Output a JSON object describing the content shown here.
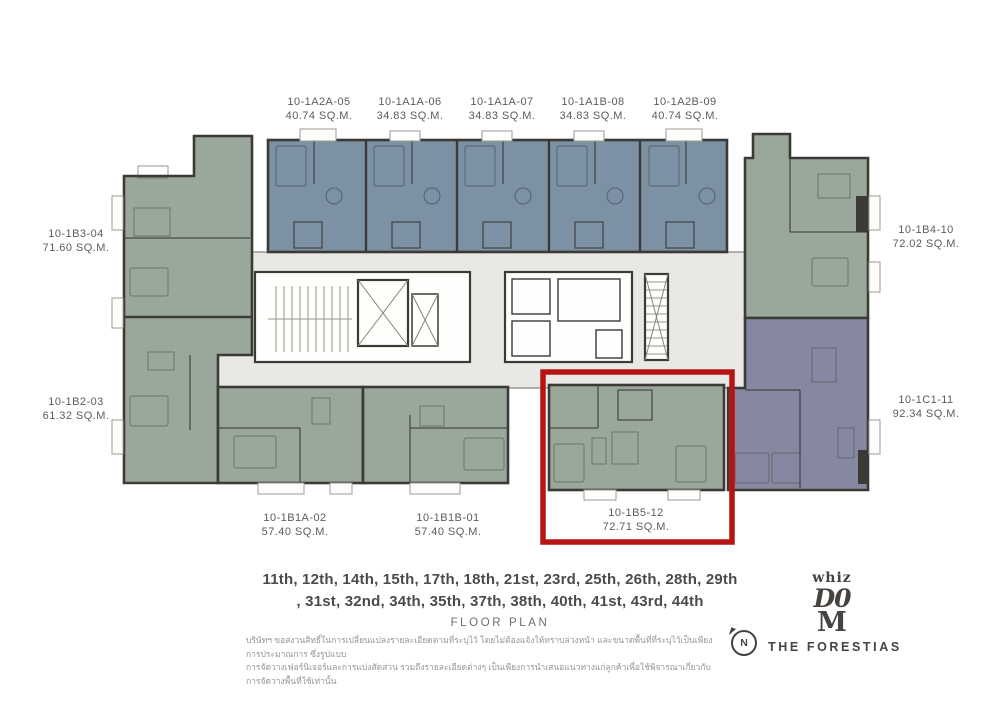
{
  "units": {
    "top": [
      {
        "id": "10-1A2A-05",
        "area": "40.74 SQ.M."
      },
      {
        "id": "10-1A1A-06",
        "area": "34.83 SQ.M."
      },
      {
        "id": "10-1A1A-07",
        "area": "34.83 SQ.M."
      },
      {
        "id": "10-1A1B-08",
        "area": "34.83 SQ.M."
      },
      {
        "id": "10-1A2B-09",
        "area": "40.74 SQ.M."
      }
    ],
    "left": [
      {
        "id": "10-1B3-04",
        "area": "71.60 SQ.M."
      },
      {
        "id": "10-1B2-03",
        "area": "61.32 SQ.M."
      }
    ],
    "right": [
      {
        "id": "10-1B4-10",
        "area": "72.02 SQ.M."
      },
      {
        "id": "10-1C1-11",
        "area": "92.34 SQ.M."
      }
    ],
    "bottom": [
      {
        "id": "10-1B1A-02",
        "area": "57.40 SQ.M."
      },
      {
        "id": "10-1B1B-01",
        "area": "57.40 SQ.M."
      },
      {
        "id": "10-1B5-12",
        "area": "72.71 SQ.M.",
        "highlighted": true
      }
    ]
  },
  "floors": {
    "line1": "11th, 12th, 14th, 15th, 17th, 18th, 21st, 23rd, 25th, 26th, 28th, 29th",
    "line2": ", 31st, 32nd, 34th, 35th, 37th, 38th, 40th, 41st, 43rd, 44th",
    "caption": "FLOOR PLAN"
  },
  "disclaimer": {
    "line1": "บริษัทฯ ขอสงวนสิทธิ์ในการเปลี่ยนแปลงรายละเอียดตามที่ระบุไว้ โดยไม่ต้องแจ้งให้ทราบล่วงหน้า และขนาดพื้นที่ที่ระบุไว้เป็นเพียงการประมาณการ ซึ่งรูปแบบ",
    "line2": "การจัดวางเฟอร์นิเจอร์และการแบ่งสัดส่วน รวมถึงรายละเอียดต่างๆ เป็นเพียงการนำเสนอแนวทางแก่ลูกค้าเพื่อใช้พิจารณาเกี่ยวกับการจัดวางพื้นที่ใช้เท่านั้น"
  },
  "compass": {
    "label": "N"
  },
  "brand": {
    "logo_line1": "whiz",
    "logo_line2": "D0",
    "logo_line3": "M",
    "name": "THE FORESTIAS"
  },
  "colors": {
    "green": "#9AA89B",
    "blue": "#7C91A4",
    "purple": "#8588A0",
    "core": "#E9E8E5",
    "wall": "#3C3A37",
    "highlight": "#B51412",
    "text": "#5B5C60",
    "heading": "#4C4B49",
    "muted": "#6E6D6B",
    "thai": "#969594",
    "brand": "#474340"
  }
}
